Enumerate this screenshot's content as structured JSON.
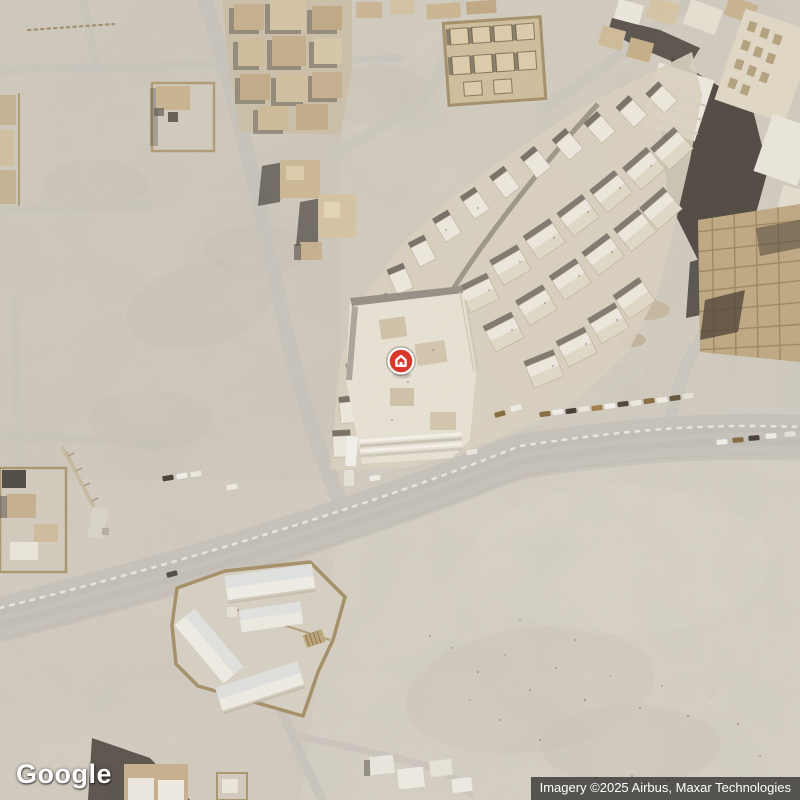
{
  "map": {
    "type": "satellite",
    "view": {
      "width": 800,
      "height": 800
    },
    "provider_logo": "Google",
    "attribution": "Imagery ©2025 Airbus, Maxar Technologies",
    "marker": {
      "kind": "saved-home-place",
      "icon": "home-icon",
      "x": 401,
      "y": 361,
      "color": "#DA382D",
      "ring": "#FFFFFF"
    },
    "colors": {
      "sand": "#D6D0C4",
      "sand2": "#CDC5B6",
      "sandlight": "#DCD7CB",
      "road": "#C9C5BD",
      "roadlight": "#D1CDC5",
      "shadow": "#56504A",
      "shadowdark": "#4A443D",
      "roof": "#EFEAE0",
      "cream": "#E3DBC9",
      "tan": "#C9B392",
      "tandark": "#A8936C",
      "brown": "#8F7A58",
      "red": "#DA382D"
    }
  }
}
